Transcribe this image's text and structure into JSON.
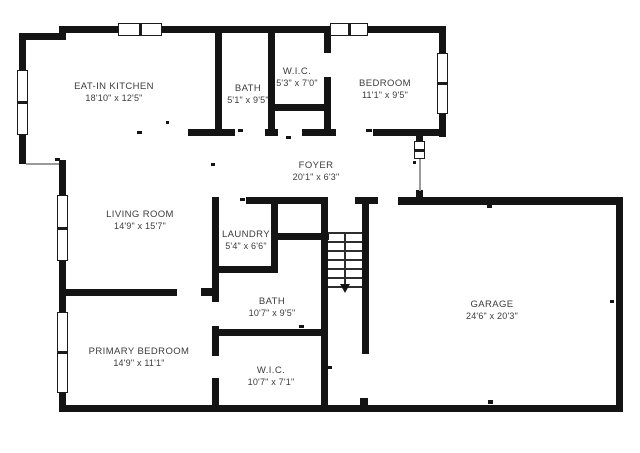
{
  "plan": {
    "colors": {
      "wall": "#141414",
      "text": "#3c3c3c",
      "background": "#ffffff",
      "opening_line": "#9a9a9a"
    },
    "rooms": [
      {
        "name": "EAT-IN KITCHEN",
        "dims": "18'10\" x 12'5\"",
        "cx": 114,
        "cy": 92
      },
      {
        "name": "BATH",
        "dims": "5'1\" x 9'5\"",
        "cx": 248,
        "cy": 94
      },
      {
        "name": "W.I.C.",
        "dims": "5'3\" x 7'0\"",
        "cx": 297,
        "cy": 77
      },
      {
        "name": "BEDROOM",
        "dims": "11'1\" x 9'5\"",
        "cx": 385,
        "cy": 89
      },
      {
        "name": "FOYER",
        "dims": "20'1\" x 6'3\"",
        "cx": 316,
        "cy": 171
      },
      {
        "name": "LIVING ROOM",
        "dims": "14'9\" x 15'7\"",
        "cx": 140,
        "cy": 220
      },
      {
        "name": "LAUNDRY",
        "dims": "5'4\" x 6'6\"",
        "cx": 246,
        "cy": 240
      },
      {
        "name": "BATH",
        "dims": "10'7\" x 9'5\"",
        "cx": 272,
        "cy": 307
      },
      {
        "name": "PRIMARY BEDROOM",
        "dims": "14'9\" x 11'1\"",
        "cx": 139,
        "cy": 357
      },
      {
        "name": "W.I.C.",
        "dims": "10'7\" x 7'1\"",
        "cx": 271,
        "cy": 376
      },
      {
        "name": "GARAGE",
        "dims": "24'6\" x 20'3\"",
        "cx": 492,
        "cy": 310
      }
    ],
    "walls": [
      [
        59,
        26,
        387,
        7
      ],
      [
        19,
        33,
        47,
        7
      ],
      [
        19,
        33,
        7,
        131
      ],
      [
        59,
        160,
        7,
        252
      ],
      [
        59,
        405,
        564,
        7
      ],
      [
        616,
        197,
        7,
        215
      ],
      [
        398,
        197,
        225,
        8
      ],
      [
        439,
        26,
        7,
        111
      ],
      [
        215,
        26,
        7,
        110
      ],
      [
        268,
        26,
        7,
        110
      ],
      [
        324,
        26,
        7,
        27
      ],
      [
        324,
        77,
        7,
        59
      ],
      [
        268,
        104,
        63,
        7
      ],
      [
        188,
        129,
        47,
        7
      ],
      [
        265,
        129,
        13,
        7
      ],
      [
        302,
        129,
        34,
        7
      ],
      [
        373,
        129,
        73,
        7
      ],
      [
        416,
        129,
        7,
        15
      ],
      [
        416,
        190,
        7,
        15
      ],
      [
        246,
        197,
        76,
        7
      ],
      [
        355,
        197,
        23,
        7
      ],
      [
        212,
        197,
        7,
        76
      ],
      [
        271,
        204,
        7,
        62
      ],
      [
        212,
        266,
        66,
        7
      ],
      [
        271,
        233,
        58,
        7
      ],
      [
        321,
        197,
        7,
        208
      ],
      [
        362,
        197,
        7,
        157
      ],
      [
        212,
        273,
        7,
        29
      ],
      [
        201,
        288,
        18,
        8
      ],
      [
        212,
        326,
        7,
        30
      ],
      [
        212,
        378,
        7,
        27
      ],
      [
        212,
        329,
        109,
        7
      ],
      [
        59,
        289,
        118,
        7
      ]
    ],
    "windows": [
      {
        "x": 118,
        "y": 23,
        "w": 44,
        "h": 13,
        "o": "h"
      },
      {
        "x": 330,
        "y": 23,
        "w": 38,
        "h": 13,
        "o": "h"
      },
      {
        "x": 17,
        "y": 70,
        "w": 11,
        "h": 65,
        "o": "v"
      },
      {
        "x": 57,
        "y": 195,
        "w": 11,
        "h": 66,
        "o": "v"
      },
      {
        "x": 57,
        "y": 312,
        "w": 11,
        "h": 81,
        "o": "v"
      },
      {
        "x": 437,
        "y": 53,
        "w": 11,
        "h": 61,
        "o": "v"
      },
      {
        "x": 414,
        "y": 141,
        "w": 11,
        "h": 18,
        "o": "v"
      }
    ],
    "opening_lines": [
      [
        26,
        163,
        33,
        2
      ],
      [
        419,
        158,
        2,
        33
      ]
    ],
    "ticks": [
      [
        137,
        131,
        5,
        3
      ],
      [
        55,
        158,
        5,
        3
      ],
      [
        166,
        121,
        3,
        3
      ],
      [
        238,
        129,
        5,
        3
      ],
      [
        286,
        136,
        5,
        3
      ],
      [
        366,
        129,
        6,
        3
      ],
      [
        413,
        161,
        3,
        3
      ],
      [
        487,
        205,
        5,
        3
      ],
      [
        488,
        400,
        5,
        4
      ],
      [
        610,
        300,
        4,
        3
      ],
      [
        299,
        325,
        5,
        3
      ],
      [
        328,
        366,
        4,
        3
      ],
      [
        240,
        198,
        5,
        3
      ],
      [
        360,
        398,
        8,
        7
      ],
      [
        211,
        163,
        4,
        3
      ]
    ],
    "stairs": {
      "tread_x": 328,
      "tread_w": 34,
      "tread_ys": [
        232,
        241,
        250,
        259,
        268,
        277,
        286
      ],
      "rail": {
        "x": 344,
        "y": 232,
        "w": 2,
        "h": 52
      },
      "arrow": {
        "x": 340,
        "y": 284
      }
    }
  }
}
